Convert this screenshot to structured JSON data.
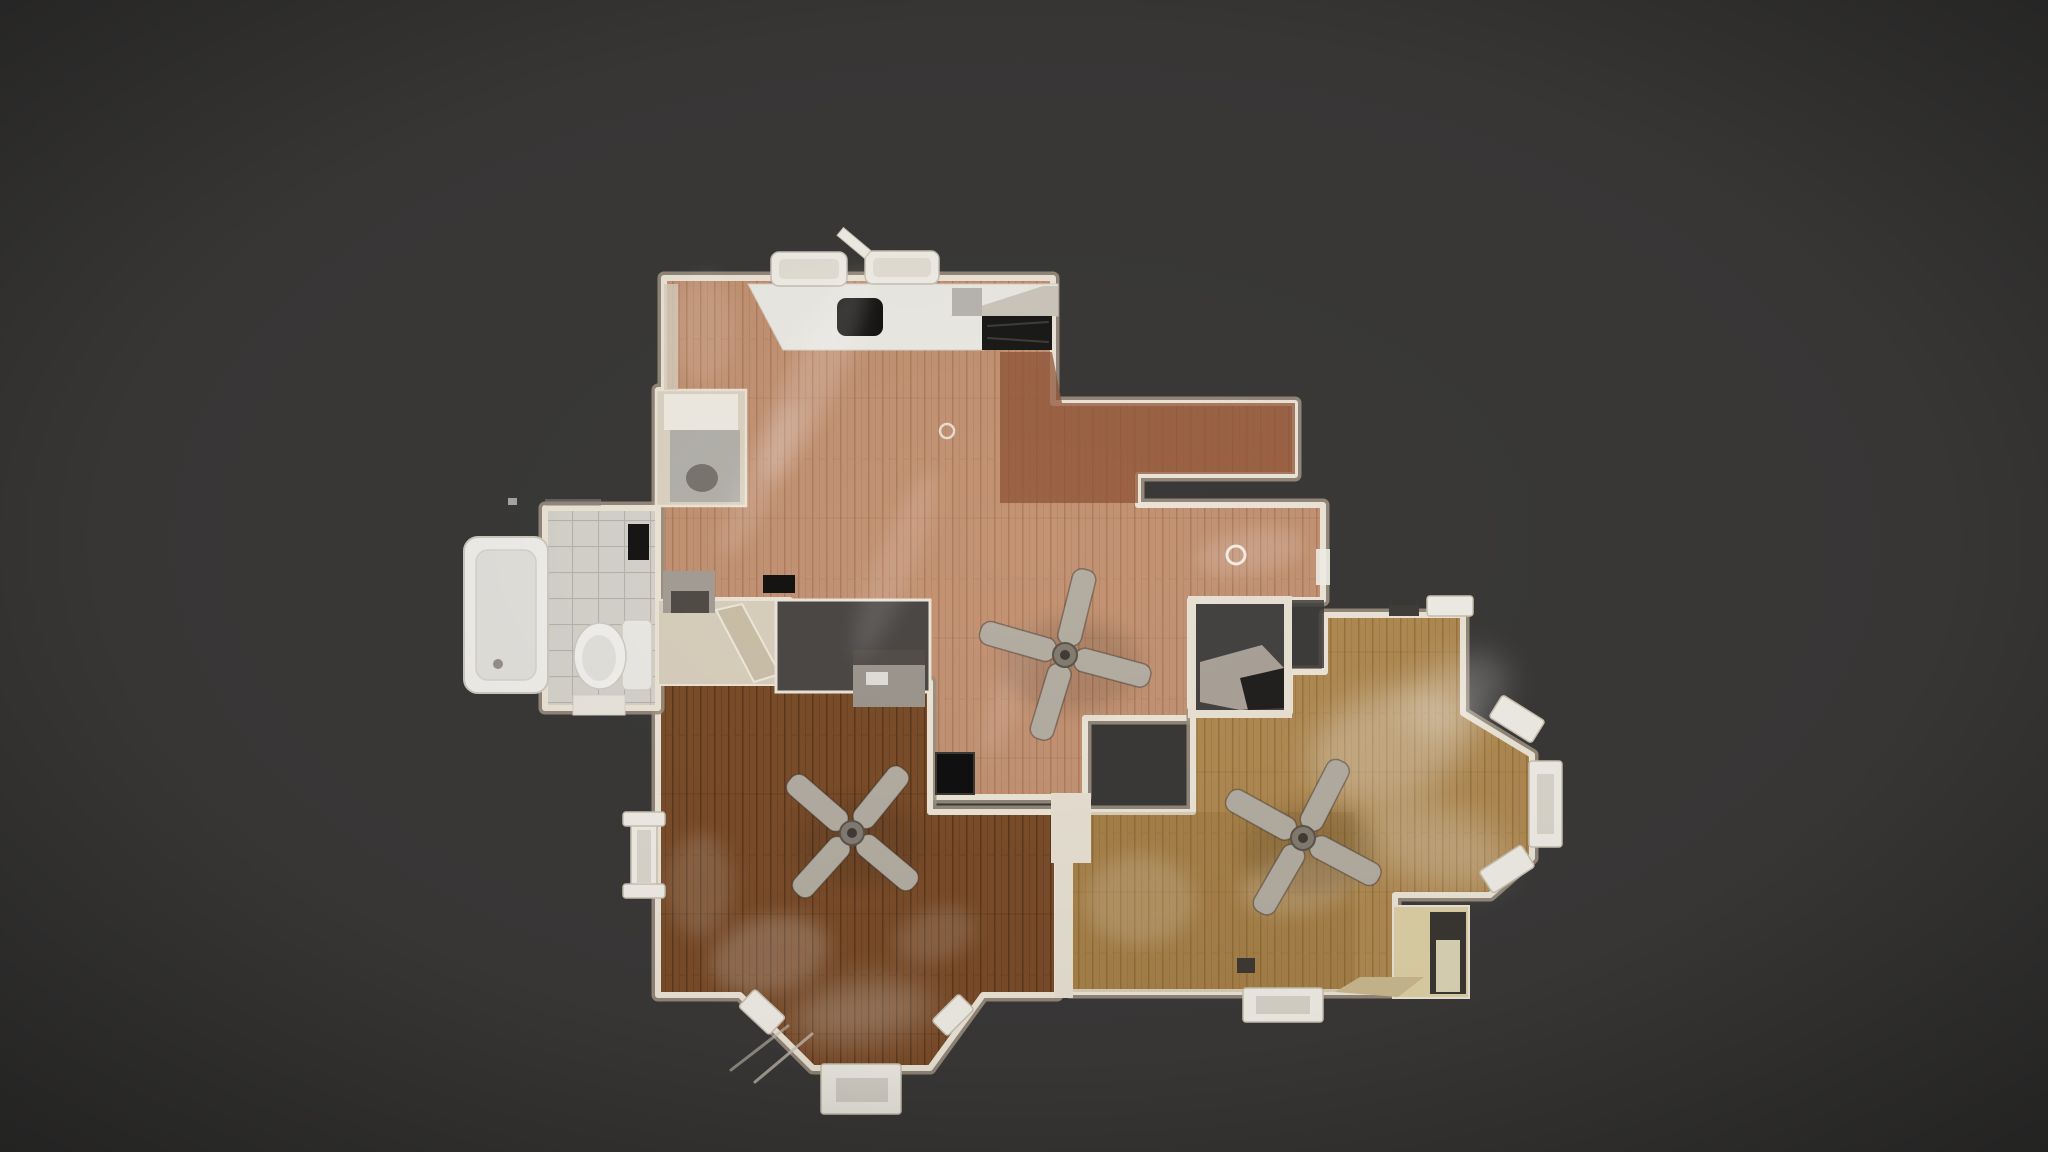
{
  "scene": {
    "label": "Top-down 3D dollhouse floor plan view of a residential level with wood floors, kitchen, bathroom and three ceiling fans",
    "background": "#3a3938",
    "canvas_width": 2048,
    "canvas_height": 1152
  },
  "palette": {
    "background": "#3a3938",
    "wall": "#ece5d7",
    "wall_shadow": "#9c9080",
    "wall_core": "#4e4a46",
    "fan_blade": "#b4ada2",
    "fan_blade_edge": "rgba(45,38,30,0.4)",
    "white_fixture": "#f1eee7",
    "fixture_edge": "#c9c2b2",
    "glow": "#ffffff",
    "woods": {
      "blush": {
        "base": "#c39374",
        "line": "rgba(128,74,44,0.30)",
        "seam": 38
      },
      "walnut": {
        "base": "#7b4d2a",
        "line": "rgba(42,22,6,0.38)",
        "seam": 74
      },
      "oak": {
        "base": "#b08a52",
        "line": "rgba(92,62,18,0.30)",
        "seam": 52
      },
      "tile": {
        "base": "#d6d2cc",
        "line": "rgba(160,156,150,0.55)",
        "seam": 0,
        "grid": true
      }
    }
  },
  "elements": [
    {
      "type": "room",
      "name": "room-central-living-kitchen",
      "wood": "blush",
      "points": "664,278 1053,278 1053,403 1295,403 1295,475 1138,475 1138,505 1323,505 1323,600 1190,600 1190,718 1085,718 1085,797 930,797 930,700 790,700 790,600 658,600 658,390 664,390"
    },
    {
      "type": "poly",
      "name": "dining-area-dark-wood",
      "points": "1000,352 1052,352 1062,403 1295,403 1295,474 1138,474 1138,503 1000,503",
      "fill": "#8d5134",
      "opacity": 0.72
    },
    {
      "type": "room",
      "name": "room-bottom-left-bedroom",
      "wood": "walnut",
      "points": "658,682 930,682 930,812 1057,812 1057,995 983,995 930,1068 813,1068 740,995 658,995"
    },
    {
      "type": "room",
      "name": "room-right-living",
      "wood": "oak",
      "points": "1325,615 1463,615 1463,713 1532,755 1532,858 1490,895 1395,895 1395,992 1070,992 1070,812 1193,812 1193,712 1290,712 1290,672 1325,672"
    },
    {
      "type": "poly",
      "name": "bottom-right-room-tint",
      "points": "1070,812 1355,812 1355,992 1070,992",
      "fill": "#7d5520",
      "opacity": 0.16
    },
    {
      "type": "room",
      "name": "room-bathroom",
      "wood": "tile",
      "points": "545,508 658,508 658,708 545,708"
    },
    {
      "type": "rect",
      "name": "fridge-nook",
      "x": 656,
      "y": 390,
      "w": 90,
      "h": 116,
      "fill": "#dcd3c2",
      "stroke": "#ece5d7",
      "sw": 2.5
    },
    {
      "type": "rect",
      "name": "fridge-nook-counter",
      "x": 664,
      "y": 394,
      "w": 74,
      "h": 36,
      "fill": "#efebe3"
    },
    {
      "type": "rect",
      "name": "fridge-nook-floor",
      "x": 670,
      "y": 430,
      "w": 70,
      "h": 72,
      "fill": "#b4b1ab"
    },
    {
      "type": "ellipse",
      "name": "fridge-nook-shadow",
      "cx": 702,
      "cy": 478,
      "rx": 16,
      "ry": 14,
      "fill": "#716b64",
      "opacity": 0.85
    },
    {
      "type": "rect",
      "name": "kitchen-left-trim",
      "x": 664,
      "y": 284,
      "w": 14,
      "h": 106,
      "fill": "#d8cfbf",
      "opacity": 0.8
    },
    {
      "type": "poly",
      "name": "kitchen-counter",
      "points": "748,284 1058,284 1058,316 983,316 983,350 783,350",
      "fill": "#eceae4",
      "stroke": "#d8d2c6",
      "sw": 1
    },
    {
      "type": "poly",
      "name": "kitchen-counter-corner-shade",
      "points": "950,316 1043,286 1058,286 1058,316",
      "fill": "#c5beb2",
      "opacity": 0.8
    },
    {
      "type": "rect",
      "name": "kitchen-sink",
      "x": 837,
      "y": 298,
      "w": 46,
      "h": 38,
      "rx": 9,
      "fill": "#161514"
    },
    {
      "type": "rect",
      "name": "kitchen-stove-cooktop",
      "x": 982,
      "y": 316,
      "w": 70,
      "h": 34,
      "fill": "#1b1a19"
    },
    {
      "type": "line",
      "name": "stove-grate-line",
      "x1": 988,
      "y1": 326,
      "x2": 1048,
      "y2": 322,
      "stroke": "#4a4742",
      "sw": 2,
      "opacity": 0.8
    },
    {
      "type": "line",
      "name": "stove-grate-line",
      "x1": 988,
      "y1": 338,
      "x2": 1048,
      "y2": 342,
      "stroke": "#4a4742",
      "sw": 2,
      "opacity": 0.8
    },
    {
      "type": "rect",
      "name": "kitchen-counter-gray-box",
      "x": 952,
      "y": 288,
      "w": 30,
      "h": 28,
      "fill": "#b9b6b0"
    },
    {
      "type": "chair",
      "name": "counter-stool",
      "x": 771,
      "y": 252,
      "w": 76,
      "h": 34
    },
    {
      "type": "chair",
      "name": "counter-stool",
      "x": 865,
      "y": 251,
      "w": 74,
      "h": 33
    },
    {
      "type": "rect",
      "name": "counter-stool-leg",
      "x": 836,
      "y": 238,
      "w": 36,
      "h": 10,
      "rot": 40,
      "fill": "#f1eee7",
      "stroke": "#c9c2b2",
      "sw": 1
    },
    {
      "type": "rect",
      "name": "bathtub",
      "x": 464,
      "y": 537,
      "w": 84,
      "h": 156,
      "rx": 14,
      "fill": "#f0efec",
      "stroke": "#cfcac0",
      "sw": 2
    },
    {
      "type": "rect",
      "name": "bathtub-basin",
      "x": 476,
      "y": 550,
      "w": 60,
      "h": 130,
      "rx": 12,
      "fill": "#e3e1dc",
      "stroke": "#d8d4cb",
      "sw": 1.5
    },
    {
      "type": "ellipse",
      "name": "bathtub-drain",
      "cx": 498,
      "cy": 664,
      "rx": 5,
      "ry": 5,
      "fill": "#96918a"
    },
    {
      "type": "rect",
      "name": "toilet-tank",
      "x": 622,
      "y": 620,
      "w": 30,
      "h": 70,
      "rx": 6,
      "fill": "#eceae5",
      "stroke": "#d4cfc5",
      "sw": 1.5
    },
    {
      "type": "ellipse",
      "name": "toilet-bowl",
      "cx": 600,
      "cy": 656,
      "rx": 26,
      "ry": 33,
      "fill": "#f2f1ee",
      "stroke": "#d0cbc1",
      "sw": 1.5
    },
    {
      "type": "ellipse",
      "name": "toilet-seat",
      "cx": 599,
      "cy": 658,
      "rx": 17,
      "ry": 23,
      "fill": "#e4e2dd"
    },
    {
      "type": "rect",
      "name": "bathroom-mirror",
      "x": 628,
      "y": 524,
      "w": 21,
      "h": 36,
      "fill": "#171614"
    },
    {
      "type": "rect",
      "name": "bathroom-threshold",
      "x": 573,
      "y": 695,
      "w": 52,
      "h": 20,
      "fill": "#eae6de",
      "stroke": "#d6d1c6",
      "sw": 1
    },
    {
      "type": "rect",
      "name": "hall-closet",
      "x": 658,
      "y": 600,
      "w": 118,
      "h": 85,
      "fill": "#d9cfbd",
      "stroke": "#ece5d7",
      "sw": 2
    },
    {
      "type": "poly",
      "name": "closet-open-door",
      "points": "716,610 742,604 780,674 754,682",
      "fill": "#cbbfa8",
      "stroke": "#efe9dc",
      "sw": 2
    },
    {
      "type": "rect",
      "name": "stair-opening-dark",
      "x": 776,
      "y": 600,
      "w": 154,
      "h": 92,
      "fill": "#4b4846",
      "stroke": "#ece5d7",
      "sw": 3
    },
    {
      "type": "rect",
      "name": "hall-desk",
      "x": 853,
      "y": 650,
      "w": 72,
      "h": 57,
      "fill": "#9c968e"
    },
    {
      "type": "rect",
      "name": "hall-desk-top",
      "x": 853,
      "y": 650,
      "w": 72,
      "h": 15,
      "fill": "#534e49"
    },
    {
      "type": "rect",
      "name": "hall-desk-paper",
      "x": 866,
      "y": 672,
      "w": 22,
      "h": 13,
      "fill": "#e8e6e0",
      "opacity": 0.9
    },
    {
      "type": "rect",
      "name": "hall-appliance",
      "x": 663,
      "y": 571,
      "w": 52,
      "h": 42,
      "fill": "#a49e96"
    },
    {
      "type": "rect",
      "name": "hall-appliance-front",
      "x": 671,
      "y": 591,
      "w": 38,
      "h": 22,
      "fill": "#514c46"
    },
    {
      "type": "rect",
      "name": "floor-vent",
      "x": 763,
      "y": 575,
      "w": 32,
      "h": 18,
      "fill": "#151413"
    },
    {
      "type": "rect",
      "name": "floor-vent-corner",
      "x": 936,
      "y": 753,
      "w": 38,
      "h": 41,
      "fill": "#111010",
      "stroke": "#3c3833",
      "sw": 2
    },
    {
      "type": "rect",
      "name": "floor-vent",
      "x": 1237,
      "y": 958,
      "w": 18,
      "h": 15,
      "fill": "#3f3a33"
    },
    {
      "type": "rect",
      "name": "stairwell-notch-trim",
      "x": 1188,
      "y": 596,
      "w": 104,
      "h": 122,
      "fill": "#e9e2d4"
    },
    {
      "type": "rect",
      "name": "stairwell-notch-dark",
      "x": 1196,
      "y": 604,
      "w": 88,
      "h": 106,
      "fill": "#454341"
    },
    {
      "type": "poly",
      "name": "stair-landing",
      "points": "1200,662 1262,645 1284,668 1284,706 1240,710 1200,702",
      "fill": "#aaa298"
    },
    {
      "type": "poly",
      "name": "stair-under-shadow",
      "points": "1240,678 1284,668 1284,708 1248,710",
      "fill": "#23211f"
    },
    {
      "type": "rect",
      "name": "stairwell-open-gap",
      "x": 1292,
      "y": 600,
      "w": 32,
      "h": 68,
      "fill": "#3f3d3b",
      "opacity": 0.85
    },
    {
      "type": "rect",
      "name": "shared-wall-bottom-rooms",
      "x": 1055,
      "y": 808,
      "w": 18,
      "h": 190,
      "fill": "#e7e0d2"
    },
    {
      "type": "rect",
      "name": "doorway-connector-wall",
      "x": 1051,
      "y": 793,
      "w": 40,
      "h": 70,
      "fill": "#e7e0d2"
    },
    {
      "type": "rect",
      "name": "lower-arm-doorframe",
      "x": 1316,
      "y": 549,
      "w": 14,
      "h": 36,
      "fill": "#f1eee7",
      "opacity": 0.9
    },
    {
      "type": "rect",
      "name": "entry-alcove",
      "x": 1393,
      "y": 906,
      "w": 76,
      "h": 92,
      "fill": "#ded1a6",
      "stroke": "#ece5d7",
      "sw": 2
    },
    {
      "type": "rect",
      "name": "entry-alcove-opening",
      "x": 1430,
      "y": 912,
      "w": 36,
      "h": 82,
      "fill": "#3b3733"
    },
    {
      "type": "rect",
      "name": "entry-alcove-lit-floor",
      "x": 1436,
      "y": 940,
      "w": 24,
      "h": 52,
      "fill": "#efe7c4",
      "opacity": 0.9
    },
    {
      "type": "poly",
      "name": "entry-threshold",
      "points": "1335,992 1360,977 1424,977 1398,997",
      "fill": "#cbb990"
    },
    {
      "type": "rect",
      "name": "bathroom-edge-artifact",
      "x": 545,
      "y": 499,
      "w": 56,
      "h": 7,
      "fill": "#8f8b85",
      "opacity": 0.5
    },
    {
      "type": "rect",
      "name": "bathroom-edge-artifact",
      "x": 508,
      "y": 498,
      "w": 9,
      "h": 7,
      "fill": "#d9d5cd",
      "opacity": 0.7
    },
    {
      "type": "glow",
      "name": "floor-reflection",
      "cx": 815,
      "cy": 375,
      "rx": 115,
      "ry": 25,
      "rot": -65,
      "opacity": 0.16
    },
    {
      "type": "glow",
      "name": "floor-reflection",
      "cx": 760,
      "cy": 480,
      "rx": 85,
      "ry": 18,
      "rot": -65,
      "opacity": 0.13
    },
    {
      "type": "glow",
      "name": "floor-reflection",
      "cx": 895,
      "cy": 565,
      "rx": 100,
      "ry": 20,
      "rot": -68,
      "opacity": 0.11
    },
    {
      "type": "glow",
      "name": "floor-reflection",
      "cx": 1010,
      "cy": 690,
      "rx": 70,
      "ry": 16,
      "rot": -70,
      "opacity": 0.1
    },
    {
      "type": "glow",
      "name": "floor-reflection",
      "cx": 705,
      "cy": 330,
      "rx": 30,
      "ry": 55,
      "rot": 0,
      "opacity": 0.1
    },
    {
      "type": "glow",
      "name": "floor-reflection",
      "cx": 1250,
      "cy": 552,
      "rx": 55,
      "ry": 22,
      "rot": -10,
      "opacity": 0.14
    },
    {
      "type": "glow",
      "name": "floor-reflection",
      "cx": 1390,
      "cy": 745,
      "rx": 85,
      "ry": 55,
      "rot": -20,
      "opacity": 0.28,
      "blur": "strong"
    },
    {
      "type": "glow",
      "name": "floor-reflection",
      "cx": 1455,
      "cy": 695,
      "rx": 55,
      "ry": 35,
      "rot": -30,
      "opacity": 0.22,
      "blur": "strong"
    },
    {
      "type": "glow",
      "name": "floor-reflection",
      "cx": 1435,
      "cy": 845,
      "rx": 75,
      "ry": 40,
      "rot": 15,
      "opacity": 0.22,
      "blur": "strong"
    },
    {
      "type": "glow",
      "name": "floor-reflection",
      "cx": 1300,
      "cy": 885,
      "rx": 60,
      "ry": 28,
      "rot": -10,
      "opacity": 0.16
    },
    {
      "type": "glow",
      "name": "floor-reflection",
      "cx": 1140,
      "cy": 900,
      "rx": 55,
      "ry": 45,
      "rot": 0,
      "opacity": 0.15
    },
    {
      "type": "glow",
      "name": "floor-reflection",
      "cx": 770,
      "cy": 955,
      "rx": 60,
      "ry": 38,
      "rot": -15,
      "opacity": 0.18
    },
    {
      "type": "glow",
      "name": "floor-reflection",
      "cx": 862,
      "cy": 1012,
      "rx": 72,
      "ry": 30,
      "rot": -8,
      "opacity": 0.22,
      "blur": "strong"
    },
    {
      "type": "glow",
      "name": "floor-reflection",
      "cx": 700,
      "cy": 885,
      "rx": 32,
      "ry": 52,
      "rot": 0,
      "opacity": 0.12
    },
    {
      "type": "glow",
      "name": "floor-reflection",
      "cx": 935,
      "cy": 935,
      "rx": 42,
      "ry": 26,
      "rot": -20,
      "opacity": 0.12
    },
    {
      "type": "win",
      "name": "bay-window-right-large",
      "x": 1529,
      "y": 761,
      "w": 33,
      "h": 86
    },
    {
      "type": "rect",
      "name": "bay-window-right-large-glass",
      "x": 1537,
      "y": 774,
      "w": 17,
      "h": 60,
      "fill": "#dcd7cd"
    },
    {
      "type": "win",
      "name": "bay-window-right-upper",
      "x": 1492,
      "y": 706,
      "w": 50,
      "h": 26,
      "rot": 32
    },
    {
      "type": "win",
      "name": "bay-window-right-lower",
      "x": 1482,
      "y": 856,
      "w": 50,
      "h": 26,
      "rot": -33
    },
    {
      "type": "win",
      "name": "window-top-protrusion",
      "x": 1427,
      "y": 596,
      "w": 46,
      "h": 20
    },
    {
      "type": "rect",
      "name": "doorway-top-protrusion",
      "x": 1389,
      "y": 605,
      "w": 30,
      "h": 11,
      "fill": "#413e3a"
    },
    {
      "type": "win",
      "name": "window-bottom-right-room",
      "x": 1243,
      "y": 988,
      "w": 80,
      "h": 34
    },
    {
      "type": "rect",
      "name": "window-bottom-right-glass",
      "x": 1256,
      "y": 996,
      "w": 54,
      "h": 18,
      "fill": "#d9d4ca"
    },
    {
      "type": "win",
      "name": "bay-window-bottom-frame",
      "x": 821,
      "y": 1064,
      "w": 80,
      "h": 50
    },
    {
      "type": "rect",
      "name": "bay-window-bottom-glass",
      "x": 836,
      "y": 1078,
      "w": 52,
      "h": 24,
      "fill": "#d8d3c9"
    },
    {
      "type": "win",
      "name": "bay-window-bottom-left",
      "x": 741,
      "y": 1000,
      "w": 42,
      "h": 24,
      "rot": 43
    },
    {
      "type": "win",
      "name": "bay-window-bottom-right",
      "x": 934,
      "y": 1004,
      "w": 38,
      "h": 22,
      "rot": -45
    },
    {
      "type": "line",
      "name": "porch-railing",
      "x1": 812,
      "y1": 1034,
      "x2": 755,
      "y2": 1082,
      "stroke": "#c9c2b4",
      "sw": 3,
      "opacity": 0.75
    },
    {
      "type": "line",
      "name": "porch-railing",
      "x1": 788,
      "y1": 1026,
      "x2": 731,
      "y2": 1070,
      "stroke": "#c9c2b4",
      "sw": 3,
      "opacity": 0.6
    },
    {
      "type": "win",
      "name": "window-left-bedroom",
      "x": 631,
      "y": 820,
      "w": 26,
      "h": 74
    },
    {
      "type": "win",
      "name": "window-left-flange",
      "x": 623,
      "y": 812,
      "w": 42,
      "h": 14
    },
    {
      "type": "win",
      "name": "window-left-flange",
      "x": 623,
      "y": 884,
      "w": 42,
      "h": 14
    },
    {
      "type": "rect",
      "name": "window-left-glass",
      "x": 637,
      "y": 830,
      "w": 14,
      "h": 54,
      "fill": "#dcd7cd"
    },
    {
      "type": "ring",
      "name": "ceiling-light",
      "cx": 1236,
      "cy": 555,
      "r": 9,
      "sw": 3,
      "opacity": 0.95
    },
    {
      "type": "ring",
      "name": "ceiling-light",
      "cx": 947,
      "cy": 431,
      "r": 7,
      "sw": 2.5,
      "opacity": 0.8
    },
    {
      "type": "fan",
      "name": "ceiling-fan-central",
      "cx": 1065,
      "cy": 655,
      "r": 88,
      "angle": 15
    },
    {
      "type": "fan",
      "name": "ceiling-fan-bottom-left",
      "cx": 852,
      "cy": 833,
      "r": 82,
      "angle": 40
    },
    {
      "type": "fan",
      "name": "ceiling-fan-right",
      "cx": 1303,
      "cy": 838,
      "r": 86,
      "angle": 28
    },
    {
      "type": "vignette",
      "name": "vignette-overlay"
    }
  ]
}
